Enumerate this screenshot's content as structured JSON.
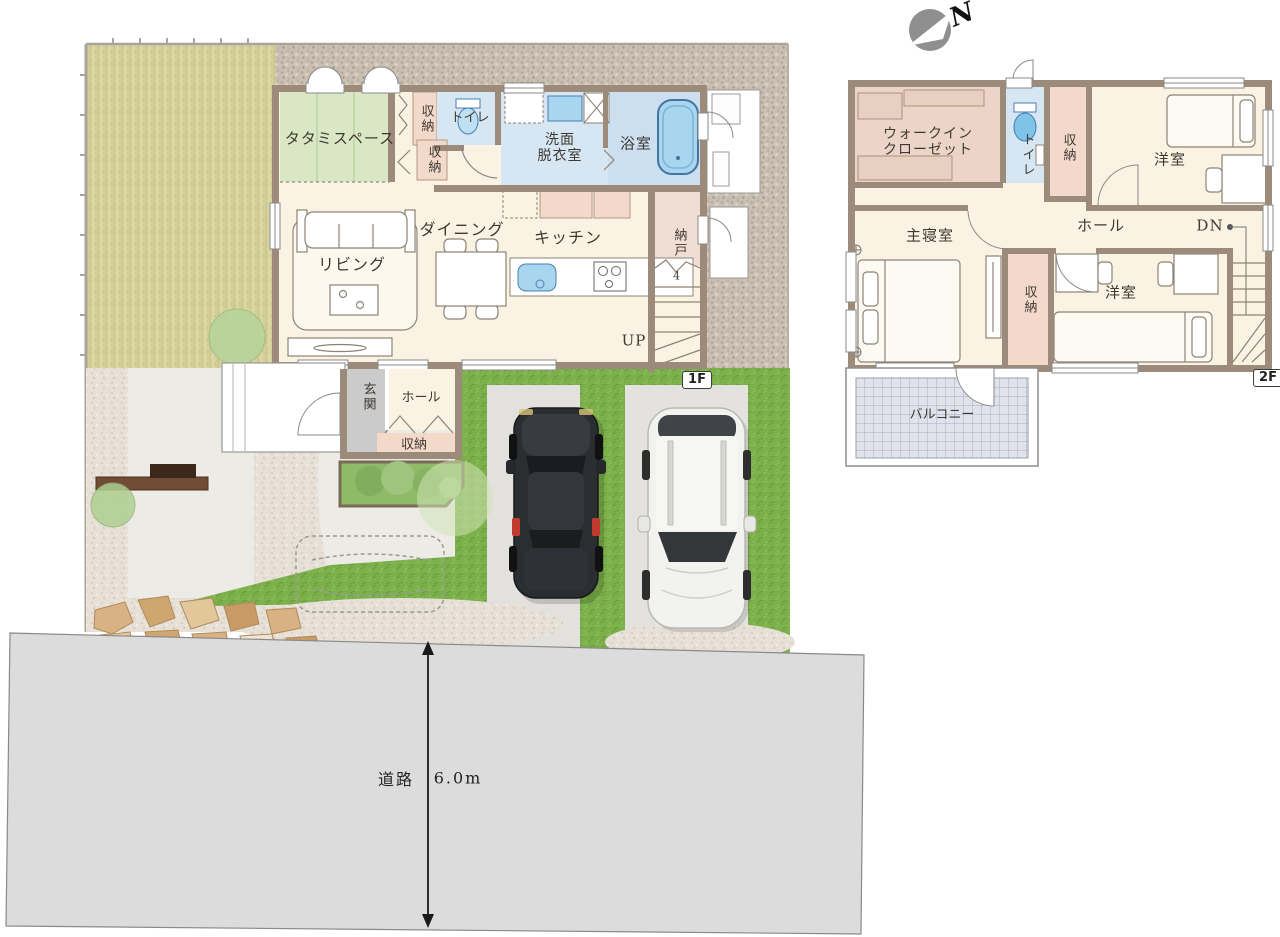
{
  "compass": {
    "north": "N"
  },
  "badges": {
    "floor1": "1F",
    "floor2": "2F"
  },
  "road": {
    "name": "道路",
    "width": "6.0m"
  },
  "floor1": {
    "tatami_space": "タタミスペース",
    "storage_top": "収納",
    "toilet": "トイレ",
    "storage_mid": "収納",
    "washroom_l1": "洗面",
    "washroom_l2": "脱衣室",
    "bathroom": "浴室",
    "living": "リビング",
    "dining": "ダイニング",
    "kitchen": "キッチン",
    "storeroom": "納戸",
    "stair_step_count": "4",
    "stairs_up": "UP",
    "entrance": "玄関",
    "hall": "ホール",
    "entrance_storage": "収納"
  },
  "floor2": {
    "walkin_l1": "ウォークイン",
    "walkin_l2": "クローゼット",
    "toilet": "トイレ",
    "storage_top": "収納",
    "bedroom_top": "洋室",
    "master_bedroom": "主寝室",
    "hall": "ホール",
    "stairs_down": "DN",
    "storage_mid": "収納",
    "bedroom_bottom": "洋室",
    "balcony": "バルコニー"
  },
  "colors": {
    "wall": "#9c8a7a",
    "floor": "#faf3e3",
    "tatami": "#d9e7c4",
    "water": "#d6e6f2",
    "bath": "#ccdff0",
    "storage": "#f3d9ca",
    "wic": "#ecd5c8",
    "genkan": "#cbcbcb",
    "lawn": "#d5d09b",
    "grass": "#7cb04b",
    "gravel": "#c9bfb2",
    "road": "#dcdcdc",
    "balcony": "#e0e3ec"
  }
}
